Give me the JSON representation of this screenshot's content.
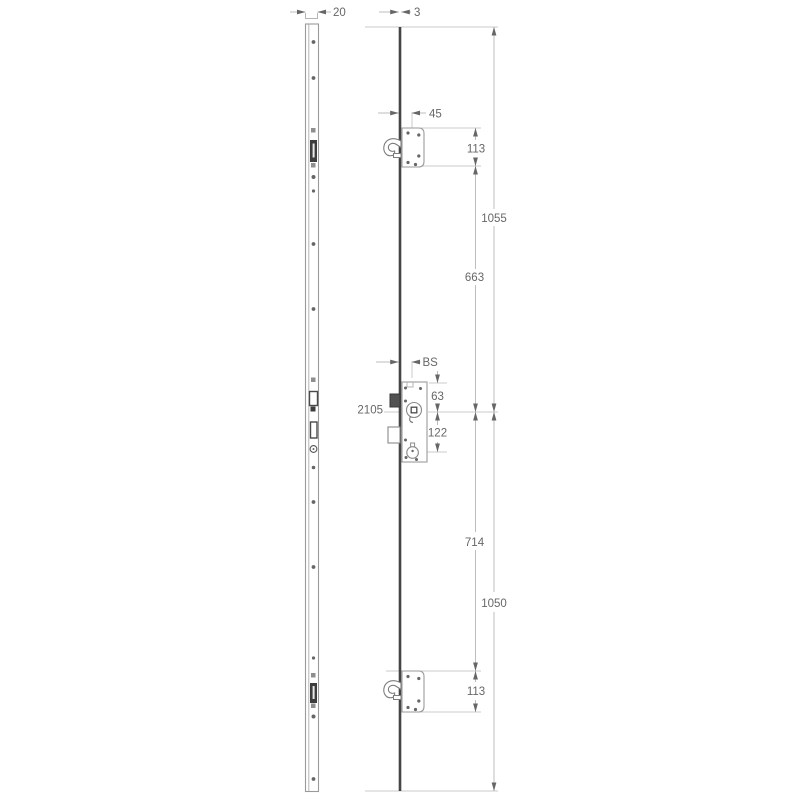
{
  "drawing": {
    "type": "technical-dimension-drawing",
    "subject": "multipoint-lock",
    "colors": {
      "background": "#ffffff",
      "extension_line": "#cbcbcb",
      "dimension_line": "#bdbdbd",
      "outline": "#9a9a9a",
      "solid_dark": "#454545",
      "text": "#676767",
      "arrow": "#666666"
    },
    "dimensions": {
      "faceplate_width": "20",
      "faceplate_thickness": "3",
      "top_hook_offset": "45",
      "top_case_height": "113",
      "top_to_spindle_overall": "1055",
      "top_case_to_spindle": "663",
      "backset": "BS",
      "total_length": "2105",
      "case_top_to_spindle": "63",
      "spindle_to_cylinder": "122",
      "spindle_to_bottom_case": "714",
      "spindle_to_bottom_overall": "1050",
      "bottom_case_height": "113"
    }
  }
}
